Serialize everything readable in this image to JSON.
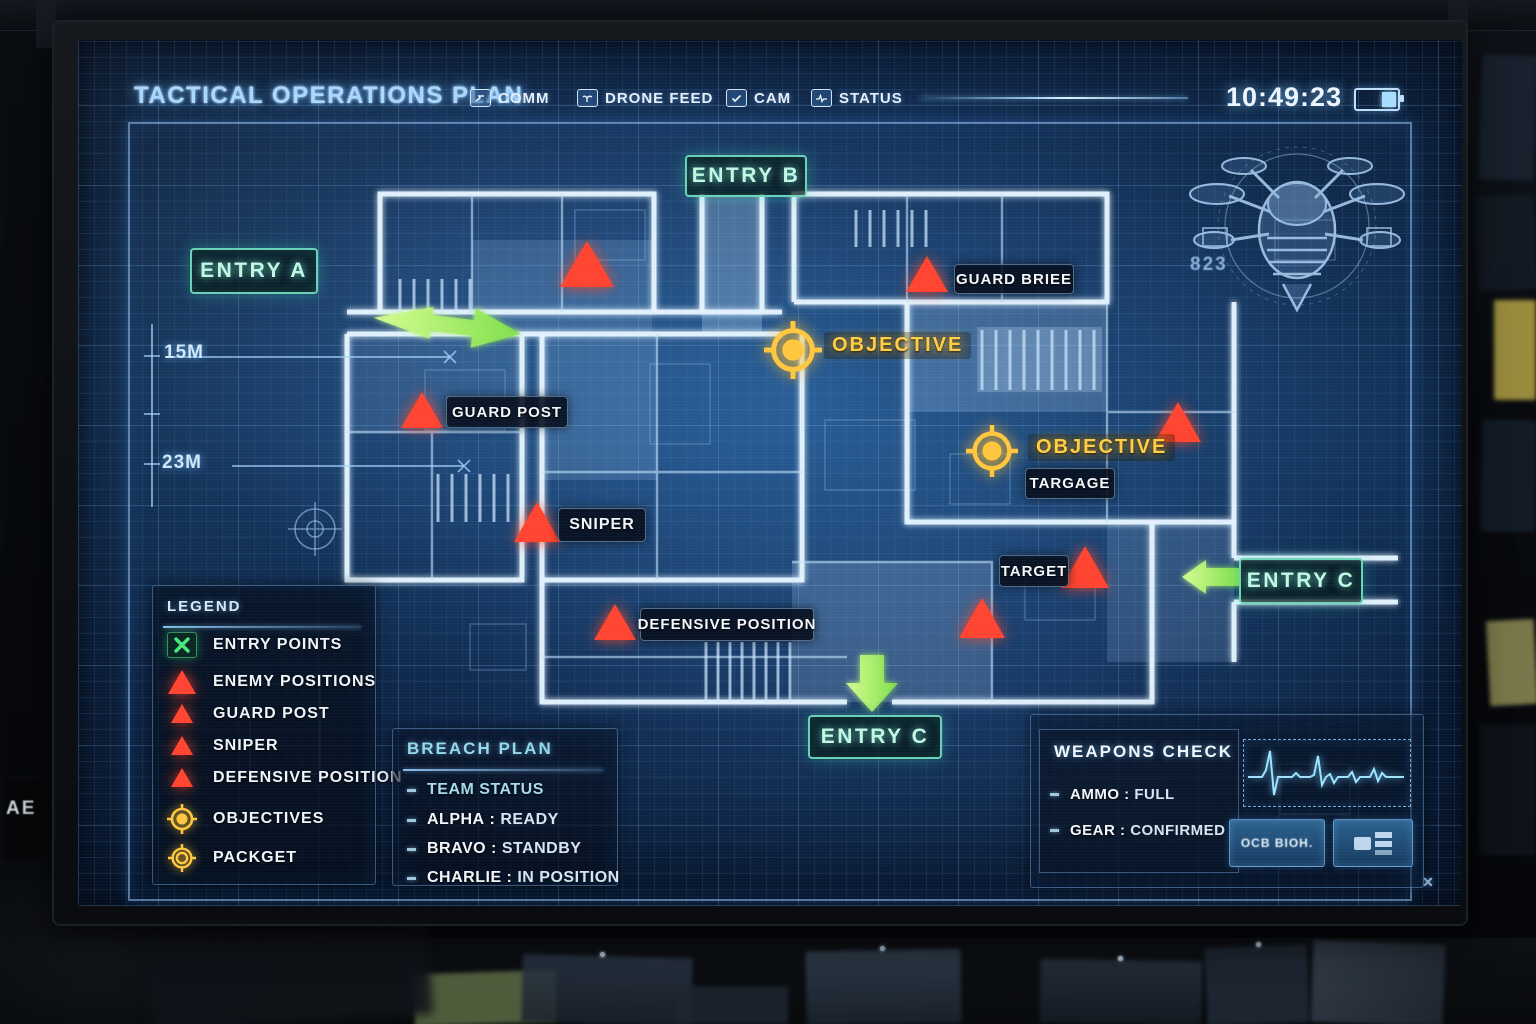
{
  "colors": {
    "accent_blue": "#8fd0ff",
    "entry_teal": "#7df0cf",
    "arrow_green": "#8ef04e",
    "enemy_red": "#ff4130",
    "objective_yellow": "#ffc640"
  },
  "scene": {
    "device_label": "AE"
  },
  "header": {
    "title": "TACTICAL OPERATIONS PLAN",
    "menu": [
      {
        "label": "COMM"
      },
      {
        "label": "DRONE FEED"
      },
      {
        "label": "CAM"
      },
      {
        "label": "STATUS"
      }
    ],
    "clock": "10:49:23"
  },
  "map": {
    "entry_a": "ENTRY A",
    "entry_b": "ENTRY B",
    "entry_c_bottom": "ENTRY C",
    "entry_c_right": "ENTRY C",
    "objective_1": "OBJECTIVE",
    "objective_2": "OBJECTIVE",
    "markers": {
      "guard_brief": "GUARD BRIEE",
      "guard_post": "GUARD POST",
      "sniper": "SNIPER",
      "defensive_position": "DEFENSIVE POSITION",
      "target": "TARGET",
      "targage": "TARGAGE"
    },
    "measurements": {
      "top": "15M",
      "bottom": "23M"
    },
    "drone_tag": "823",
    "corner_mark": "✕"
  },
  "legend": {
    "title": "LEGEND",
    "items": [
      {
        "label": "ENTRY POINTS",
        "icon": "entry-point-x-icon"
      },
      {
        "label": "ENEMY POSITIONS",
        "icon": "enemy-triangle-icon"
      },
      {
        "label": "GUARD POST",
        "icon": "guard-triangle-icon"
      },
      {
        "label": "SNIPER",
        "icon": "sniper-triangle-icon"
      },
      {
        "label": "DEFENSIVE POSITION",
        "icon": "defensive-triangle-icon"
      },
      {
        "label": "OBJECTIVES",
        "icon": "objective-crosshair-icon"
      },
      {
        "label": "PACKGET",
        "icon": "package-crosshair-icon"
      }
    ]
  },
  "breach_plan": {
    "title": "BREACH PLAN",
    "items": [
      {
        "name": "TEAM STATUS",
        "sep": "",
        "value": ""
      },
      {
        "name": "ALPHA",
        "sep": " : ",
        "value": "READY"
      },
      {
        "name": "BRAVO",
        "sep": " : ",
        "value": "STANDBY"
      },
      {
        "name": "CHARLIE",
        "sep": " : ",
        "value": "IN POSITION"
      }
    ]
  },
  "weapons_check": {
    "title": "WEAPONS CHECK",
    "items": [
      {
        "name": "AMMO",
        "sep": " : ",
        "value": "FULL"
      },
      {
        "name": "GEAR",
        "sep": " : ",
        "value": "CONFIRMED"
      }
    ],
    "ecg_button_label": "OCB BIOH."
  }
}
